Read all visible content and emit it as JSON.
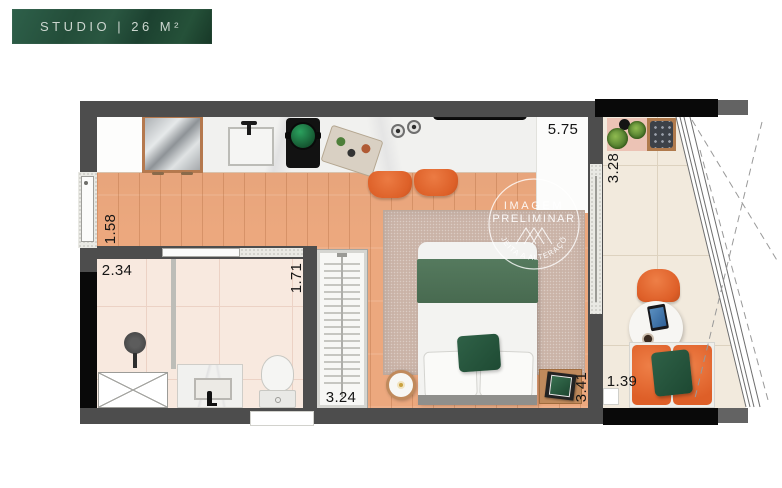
{
  "banner": {
    "label": "STUDIO | 26 M²"
  },
  "watermark": {
    "line1": "IMAGEM",
    "line2": "PRELIMINAR",
    "arc": "SUJEITA A ALTERAÇÕES",
    "logo": "mountains-icon"
  },
  "dimensions": {
    "counter_width": "5.75",
    "balcony_depth": "3.28",
    "entry_width": "1.58",
    "bathroom_width": "2.34",
    "bathroom_depth": "1.71",
    "closet_length": "3.24",
    "bedroom_wall": "3.41",
    "balcony_width": "1.39"
  },
  "colors": {
    "banner_green": "#24513B",
    "furniture_orange": "#E2672F",
    "blanket_green": "#4E7156",
    "pillow_green": "#275840",
    "wall_gray": "#4D4D4D",
    "wood_floor": "#ECA87E",
    "rug_mauve": "#CAB3A7"
  }
}
